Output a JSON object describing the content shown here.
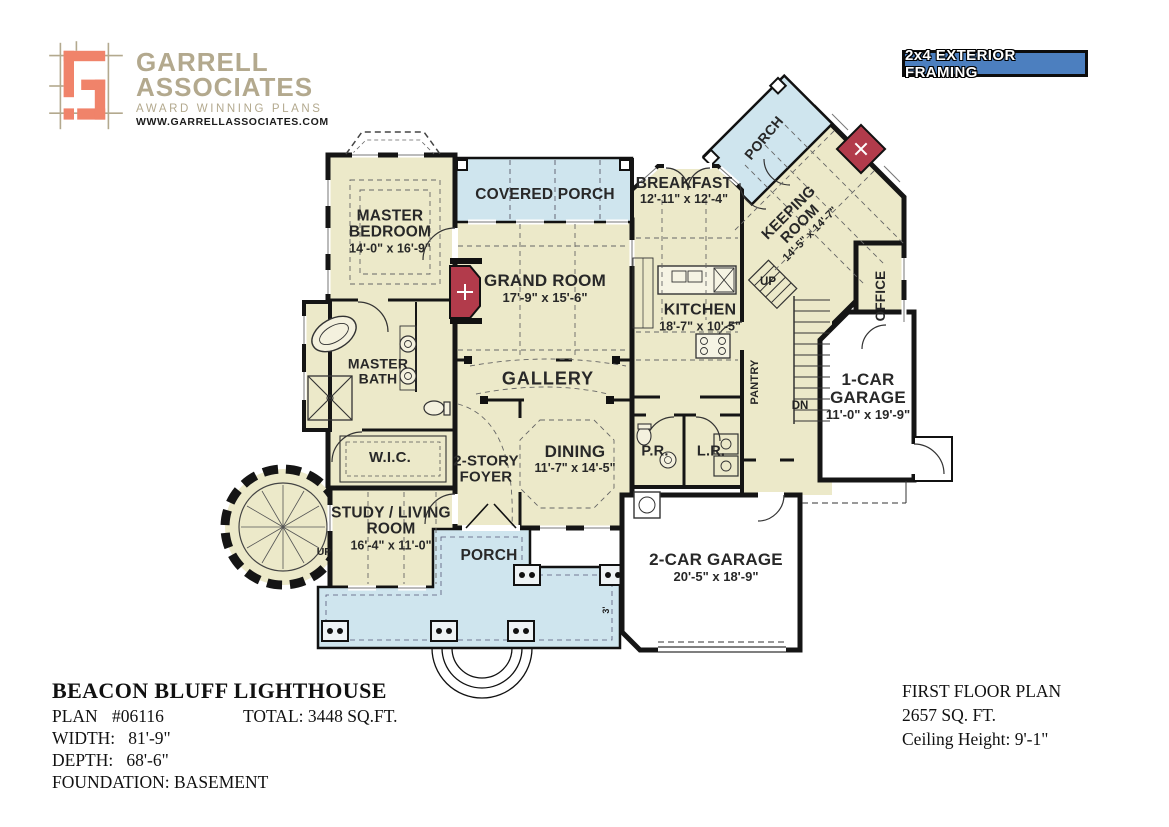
{
  "header": {
    "logo": {
      "name_line1": "GARRELL",
      "name_line2": "ASSOCIATES",
      "tagline": "AWARD WINNING PLANS",
      "website": "WWW.GARRELLASSOCIATES.COM"
    },
    "framing_badge": "2x4 EXTERIOR FRAMING"
  },
  "plan": {
    "rooms": [
      {
        "id": "master-bedroom",
        "name": "MASTER BEDROOM",
        "dims": "14'-0\" x 16'-9\""
      },
      {
        "id": "covered-porch",
        "name": "COVERED PORCH",
        "dims": ""
      },
      {
        "id": "breakfast",
        "name": "BREAKFAST",
        "dims": "12'-11\" x 12'-4\""
      },
      {
        "id": "porch-upper",
        "name": "PORCH",
        "dims": ""
      },
      {
        "id": "keeping-room",
        "name": "KEEPING ROOM",
        "dims": "14'-5\" x 14'-7\""
      },
      {
        "id": "office",
        "name": "OFFICE",
        "dims": ""
      },
      {
        "id": "grand-room",
        "name": "GRAND ROOM",
        "dims": "17'-9\" x 15'-6\""
      },
      {
        "id": "kitchen",
        "name": "KITCHEN",
        "dims": "18'-7\" x 10'-5\""
      },
      {
        "id": "pantry",
        "name": "PANTRY",
        "dims": ""
      },
      {
        "id": "master-bath",
        "name": "MASTER BATH",
        "dims": ""
      },
      {
        "id": "gallery",
        "name": "GALLERY",
        "dims": ""
      },
      {
        "id": "wic",
        "name": "W.I.C.",
        "dims": ""
      },
      {
        "id": "two-story-foyer",
        "name": "2-STORY FOYER",
        "dims": ""
      },
      {
        "id": "dining",
        "name": "DINING",
        "dims": "11'-7\" x 14'-5\""
      },
      {
        "id": "powder-room",
        "name": "P.R.",
        "dims": ""
      },
      {
        "id": "laundry-room",
        "name": "L.R.",
        "dims": ""
      },
      {
        "id": "one-car-garage",
        "name": "1-CAR GARAGE",
        "dims": "11'-0\" x 19'-9\""
      },
      {
        "id": "study-living",
        "name": "STUDY / LIVING ROOM",
        "dims": "16'-4\" x 11'-0\""
      },
      {
        "id": "porch-lower",
        "name": "PORCH",
        "dims": ""
      },
      {
        "id": "two-car-garage",
        "name": "2-CAR GARAGE",
        "dims": "20'-5\" x 18'-9\""
      }
    ],
    "annotations": {
      "up_main": "UP",
      "dn_main": "DN",
      "up_turret": "UP",
      "dim_marker": "3'"
    }
  },
  "footer": {
    "title": "BEACON BLUFF LIGHTHOUSE",
    "plan_label": "PLAN",
    "plan_number": "#06116",
    "total": "TOTAL: 3448 SQ.FT.",
    "width_line": "WIDTH:   81'-9\"",
    "depth_line": "DEPTH:   68'-6\"",
    "foundation_line": "FOUNDATION: BASEMENT",
    "right_title": "FIRST FLOOR PLAN",
    "right_area": "2657 SQ. FT.",
    "right_ceiling": "Ceiling Height: 9'-1\""
  },
  "colors": {
    "floor": "#ece9c9",
    "porch": "#cfe5ee",
    "wall": "#151515",
    "fireplace": "#b23b4b",
    "garage_floor": "#ffffff",
    "badge_blue": "#4c7fbf",
    "logo_salmon": "#f0836a",
    "logo_tan": "#b3a98e"
  }
}
